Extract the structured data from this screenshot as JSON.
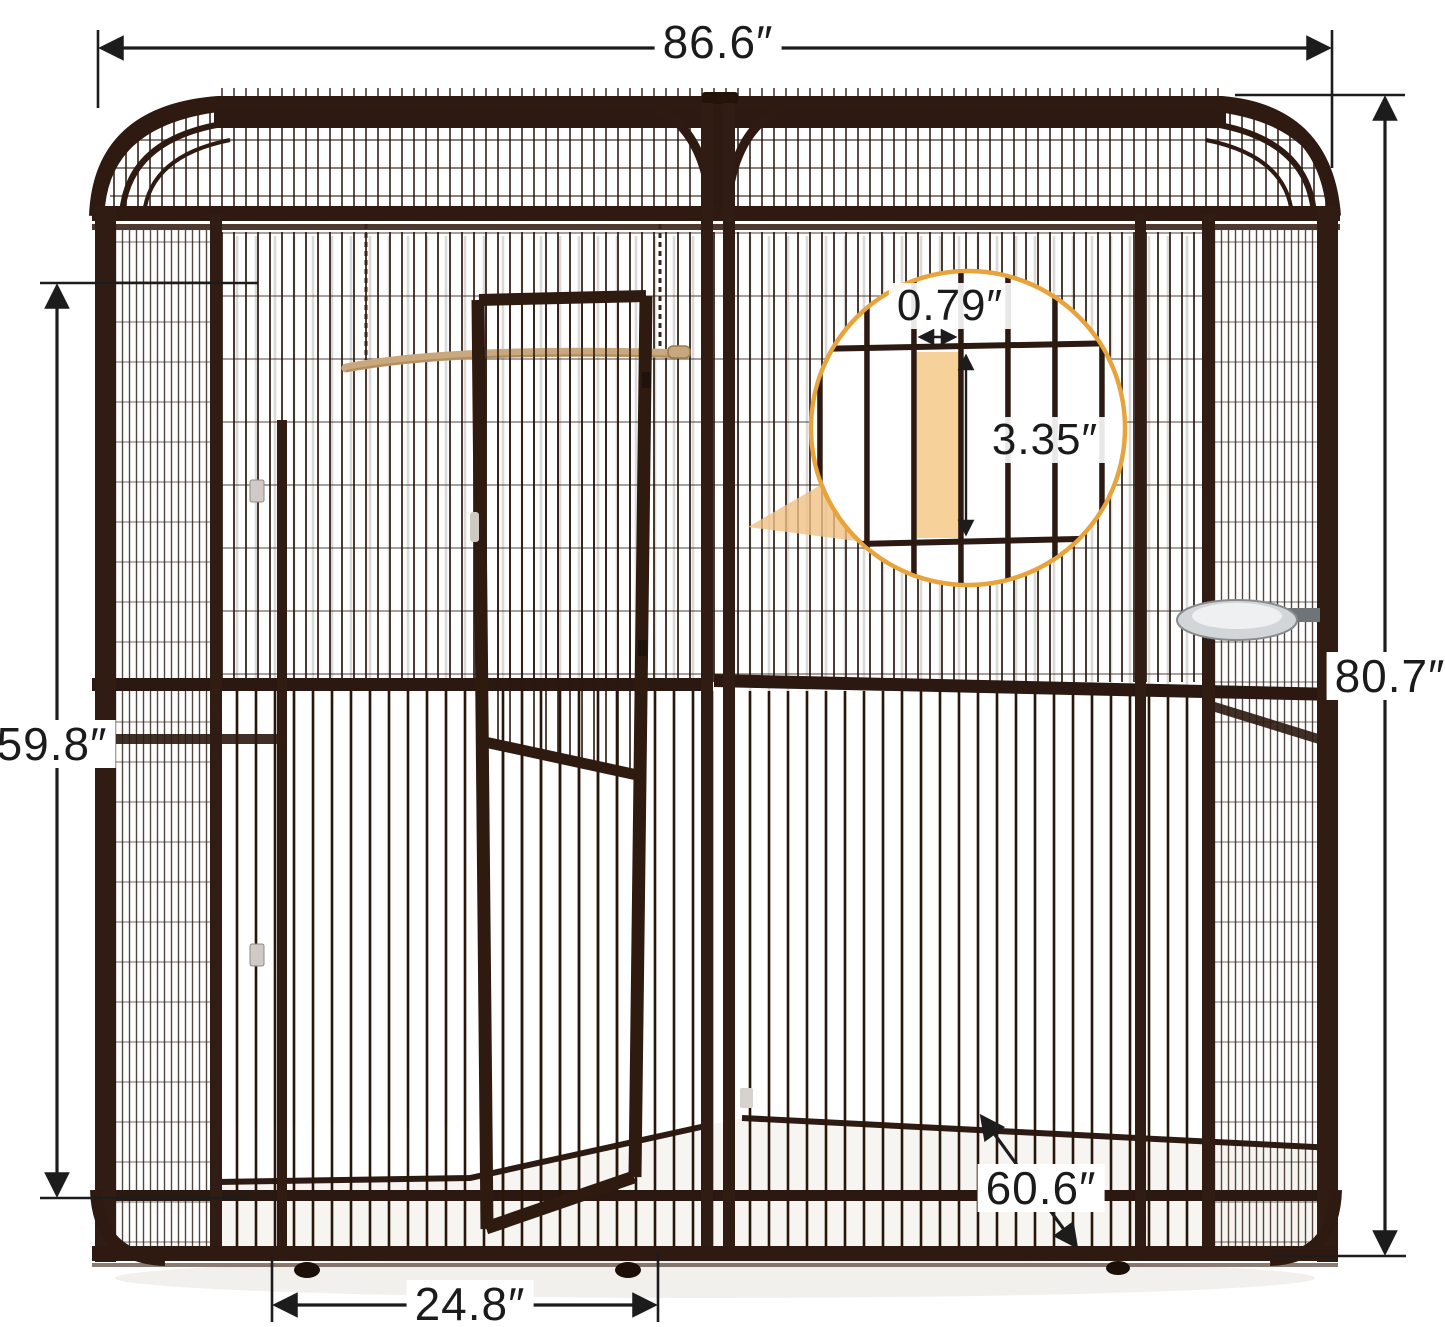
{
  "annotations": {
    "overall_width": "86.6″",
    "overall_height": "80.7″",
    "side_height": "59.8″",
    "door_width": "24.8″",
    "depth": "60.6″"
  },
  "wire_detail": {
    "bar_gap": "0.79″",
    "cell_height": "3.35″"
  },
  "colors": {
    "frame_brown": "#301c12",
    "wire_brown": "#2a1810",
    "dimension_line": "#1c1c1c",
    "magnifier_ring": "#e8a43c",
    "highlight_cell": "#f6d29a",
    "callout_wedge": "#f0c183",
    "perch_rope": "#c9a87e",
    "floor": "#f7f5f2"
  }
}
